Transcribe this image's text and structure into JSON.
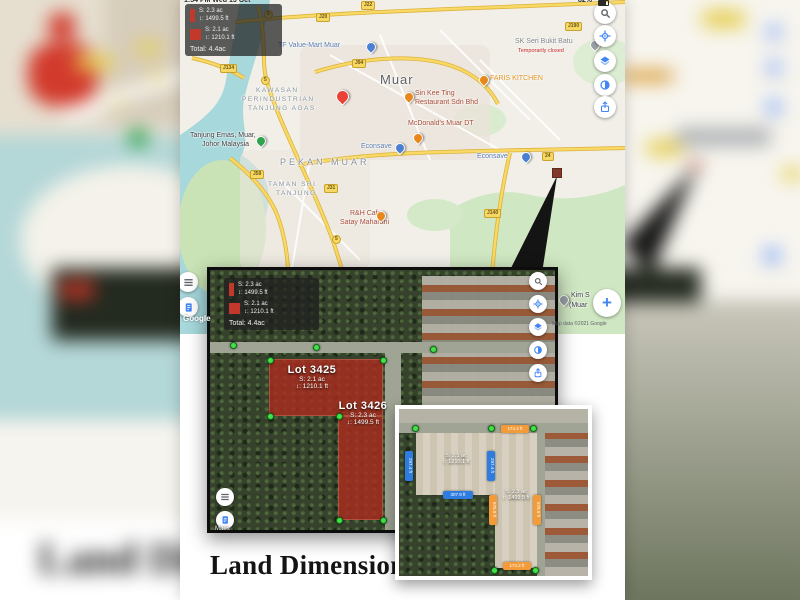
{
  "title": "Land Dimension",
  "background_text": "Land Dim",
  "status_bar": {
    "left": "1:54 PM Wed 13 Oct",
    "right": "82%"
  },
  "legend": {
    "lot_strip": {
      "area": "S: 2.3 ac",
      "perimeter": "↕: 1499.5 ft"
    },
    "lot_block": {
      "area": "S: 2.1 ac",
      "perimeter": "↕: 1210.1 ft"
    },
    "total": "Total: 4.4ac"
  },
  "map": {
    "area_labels": {
      "city": "Muar",
      "town": "PEKAN MUAR",
      "industrial_1": "KAWASAN",
      "industrial_2": "PERINDUSTRIAN",
      "industrial_3": "TANJUNG AGAS",
      "taman_1": "TAMAN SRI",
      "taman_2": "TANJUNG"
    },
    "places": {
      "tf": "TF Value-Mart Muar",
      "faris": "FARIS KITCHEN",
      "sinkee_1": "Sin Kee Ting",
      "sinkee_2": "Restaurant Sdn Bhd",
      "mcd": "McDonald's Muar DT",
      "econsave": "Econsave",
      "tanjung_1": "Tanjung Emas, Muar,",
      "tanjung_2": "Johor Malaysia",
      "rh_1": "R&H Cafe",
      "rh_2": "Satay Maharani",
      "sk": "SK Seri Bukit Batu",
      "sk_status": "Temporarily closed",
      "kim_1": "Kim S",
      "kim_2": "(Muar"
    },
    "badges": {
      "j22": "J22",
      "j20": "J20",
      "j190": "J190",
      "j94": "J94",
      "j134": "J134",
      "j59": "J59",
      "j31": "J31",
      "j140": "J140",
      "r24": "24",
      "r5": "5"
    },
    "zoom_in": "+",
    "attribution": "Map data ©2021 Google",
    "google_logo": "Google"
  },
  "satellite": {
    "lots": [
      {
        "name": "Lot 3425",
        "area": "S: 2.1 ac",
        "perimeter": "↕: 1210.1 ft"
      },
      {
        "name": "Lot 3426",
        "area": "S: 2.3 ac",
        "perimeter": "↕: 1499.5 ft"
      }
    ],
    "watermark": "Maps"
  },
  "inset": {
    "parcels": [
      {
        "area": "S: 2.1 ac",
        "perimeter": "↕: 1210.1 ft",
        "sides": [
          "297.4 ft",
          "297.4 ft",
          "307.9 ft"
        ]
      },
      {
        "area": "S: 2.3 ac",
        "perimeter": "↕: 1499.5 ft",
        "sides": [
          "174.2 ft",
          "575.9 ft",
          "575.9 ft",
          "174.2 ft"
        ]
      }
    ]
  },
  "colors": {
    "accent_blue": "#4285f4",
    "lot_red": "#b03a2e",
    "pill_blue": "#2f7ce0",
    "pill_orange": "#f29b38",
    "vertex_green": "#43e04a"
  }
}
